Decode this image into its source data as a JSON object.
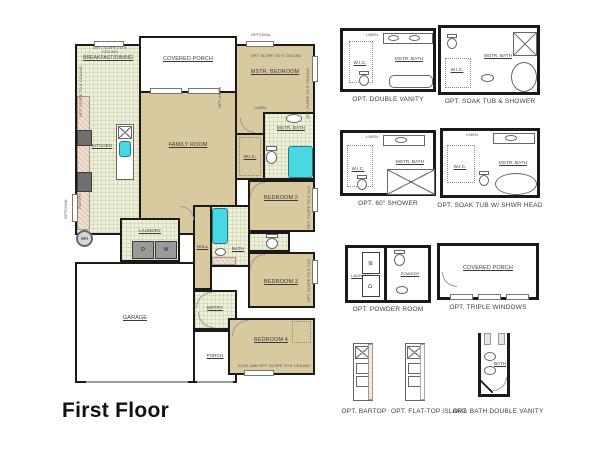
{
  "title": "First Floor",
  "colors": {
    "wall": "#1a1a1a",
    "room_fill_tan": "#d8c99e",
    "tile_fill": "#eef0da",
    "fixture_cyan": "#49d8e2",
    "counter_pink": "#e8cdb6",
    "appliance_gray": "#9a9a9a",
    "label_text": "#3a3a3a"
  },
  "main_plan": {
    "rooms": {
      "breakfast": "BREAKFAST/DINING",
      "covered_porch": "COVERED PORCH",
      "mstr_bedroom": "MSTR. BEDROOM",
      "kitchen": "KITCHEN",
      "family_room": "FAMILY ROOM",
      "wic": "W.I.C.",
      "mstr_bath": "MSTR. BATH",
      "bedroom2": "BEDROOM 2",
      "laundry": "LAUNDRY",
      "hall": "HALL",
      "bath": "BATH",
      "bedroom3": "BEDROOM 3",
      "garage": "GARAGE",
      "entry": "ENTRY",
      "porch": "PORCH",
      "bedroom4": "BEDROOM 4"
    },
    "annotations": {
      "opt_slope": "OPT. SLOPE TO 9' CEILING",
      "opt_slope_clg": "OPT. SLOPE TO 9' CLG",
      "bedroom4_note": "ELEV. A&B OPT. SLOPE TO 9' CEILING",
      "linen": "LINEN",
      "pantry": "PANTRY",
      "optional": "OPTIONAL",
      "opt_arch": "OPT. ARCH",
      "washer": "W",
      "dryer": "D",
      "water_heater": "WH"
    }
  },
  "options": [
    {
      "caption": "OPT. DOUBLE VANITY",
      "labels": {
        "wic": "W.I.C.",
        "bath": "MSTR. BATH",
        "linen": "LINEN"
      }
    },
    {
      "caption": "OPT. SOAK TUB & SHOWER",
      "labels": {
        "wic": "W.I.C.",
        "bath": "MSTR. BATH"
      }
    },
    {
      "caption": "OPT. 60\" SHOWER",
      "labels": {
        "wic": "W.I.C.",
        "bath": "MSTR. BATH",
        "linen": "LINEN"
      }
    },
    {
      "caption": "OPT. SOAK TUB W/ SHWR HEAD",
      "labels": {
        "wic": "W.I.C.",
        "bath": "MSTR. BATH",
        "linen": "LINEN"
      }
    },
    {
      "caption": "OPT. POWDER ROOM",
      "labels": {
        "laundry": "LAUNDRY",
        "powder": "POWDER",
        "washer": "W",
        "dryer": "D"
      }
    },
    {
      "caption": "OPT. TRIPLE WINDOWS",
      "labels": {
        "porch": "COVERED PORCH"
      }
    },
    {
      "caption": "OPT. BARTOP",
      "labels": {}
    },
    {
      "caption": "OPT. FLAT-TOP ISLAND",
      "labels": {}
    },
    {
      "caption": "OPT. BATH DOUBLE VANITY",
      "labels": {
        "bath": "BATH"
      }
    }
  ]
}
